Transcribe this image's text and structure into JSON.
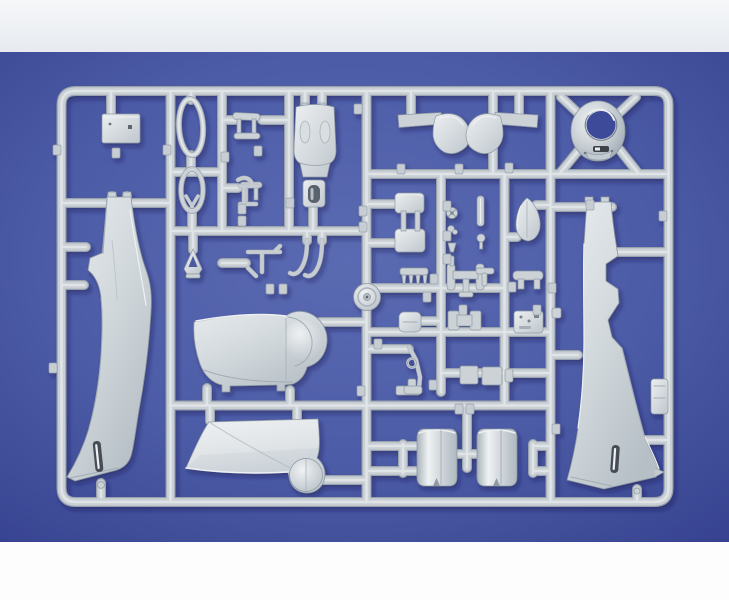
{
  "scene": {
    "description": "Photograph of a light grey injection-molded plastic model kit sprue with aircraft parts, laid on a blue backdrop with white strips at top and bottom",
    "material": "light grey polystyrene",
    "backdrop": "blue card"
  },
  "palette": {
    "page_bg": "#ffffff",
    "top_strip_light": "#f5f7f9",
    "top_strip_dark": "#e7eaef",
    "bottom_strip": "#fdfdfe",
    "blue_center": "#5b6bb2",
    "blue_mid": "#4c5ba6",
    "blue_edge": "#36428f",
    "plastic_base": "#c9cfd4",
    "plastic_light": "#e3e7ea",
    "plastic_shadow": "#99a3ad",
    "slot_dark": "#474e57",
    "cast_shadow": "#141c4e"
  },
  "sprue": {
    "parts": [
      {
        "name": "fuselage-half-left",
        "description": "left fuselage half, vertical, tail up, exhaust slot near nose"
      },
      {
        "name": "fuselage-half-right",
        "description": "right fuselage half, vertical, cockpit and wing-root cutouts"
      },
      {
        "name": "engine-cowling-ring",
        "description": "round open cowling ring, top right"
      },
      {
        "name": "cowl-flap-fairing-pair",
        "description": "mirrored rounded fairings with arms, top center"
      },
      {
        "name": "upper-fuselage-decking",
        "description": "upper fuselage spine with cheek bumps"
      },
      {
        "name": "gun-cover-panel",
        "description": "small panel with dark opening below the decking"
      },
      {
        "name": "instrument-panel-plate",
        "description": "rectangular plate, top left"
      },
      {
        "name": "canopy-frame-oval",
        "description": "open oval canopy frame"
      },
      {
        "name": "windscreen-frame-oval",
        "description": "oval frame with chevron brace"
      },
      {
        "name": "tail-gear-cover",
        "description": "small A-shaped cover"
      },
      {
        "name": "cockpit-bracket-pair",
        "description": "two small stepped brackets"
      },
      {
        "name": "control-linkages",
        "description": "small bent-rod linkage parts"
      },
      {
        "name": "exhaust-hooks",
        "description": "two J-shaped pipe parts"
      },
      {
        "name": "radiator-frame",
        "description": "ladder-like frame of two plates and struts"
      },
      {
        "name": "intake-teardrop",
        "description": "egg/teardrop shaped intake fairing"
      },
      {
        "name": "exhaust-stack-comb",
        "description": "comb-like exhaust stack strip"
      },
      {
        "name": "wing-spar-frame",
        "description": "H-shaped spar with end plates"
      },
      {
        "name": "spinner-backplate",
        "description": "round disc molded on runner"
      },
      {
        "name": "belly-cowl-section",
        "description": "bathtub-shaped belly section with round cowl bulge"
      },
      {
        "name": "lower-wing-panel",
        "description": "trapezoidal wing panel with round bulge"
      },
      {
        "name": "cowling-drum-halves",
        "description": "two barrel-shaped cowl halves, bottom right"
      },
      {
        "name": "landing-gear-leg",
        "description": "angled strut with ring"
      },
      {
        "name": "seat-bracket",
        "description": "rounded bar with two legs"
      },
      {
        "name": "instrument-boxes",
        "description": "cluster of small box parts on runners"
      },
      {
        "name": "access-hatch",
        "description": "small rectangular door on right rail"
      },
      {
        "name": "small-fittings-column",
        "description": "tiny wheels, knobs and pins on center rail"
      },
      {
        "name": "part-number-tags",
        "description": "embossed rectangular number tags on runners"
      }
    ],
    "tag_positions": [
      [
        57,
        150
      ],
      [
        53,
        368
      ],
      [
        116,
        153
      ],
      [
        167,
        150
      ],
      [
        225,
        157
      ],
      [
        258,
        151
      ],
      [
        242,
        209
      ],
      [
        242,
        221
      ],
      [
        270,
        289
      ],
      [
        283,
        289
      ],
      [
        290,
        203
      ],
      [
        358,
        109
      ],
      [
        363,
        211
      ],
      [
        363,
        227
      ],
      [
        361,
        391
      ],
      [
        378,
        344
      ],
      [
        401,
        169
      ],
      [
        459,
        169
      ],
      [
        509,
        168
      ],
      [
        447,
        206
      ],
      [
        447,
        236
      ],
      [
        447,
        259
      ],
      [
        434,
        279
      ],
      [
        427,
        297
      ],
      [
        512,
        287
      ],
      [
        552,
        288
      ],
      [
        463,
        310
      ],
      [
        537,
        310
      ],
      [
        433,
        385
      ],
      [
        459,
        409
      ],
      [
        470,
        409
      ],
      [
        556,
        429
      ],
      [
        590,
        205
      ],
      [
        663,
        216
      ]
    ]
  }
}
